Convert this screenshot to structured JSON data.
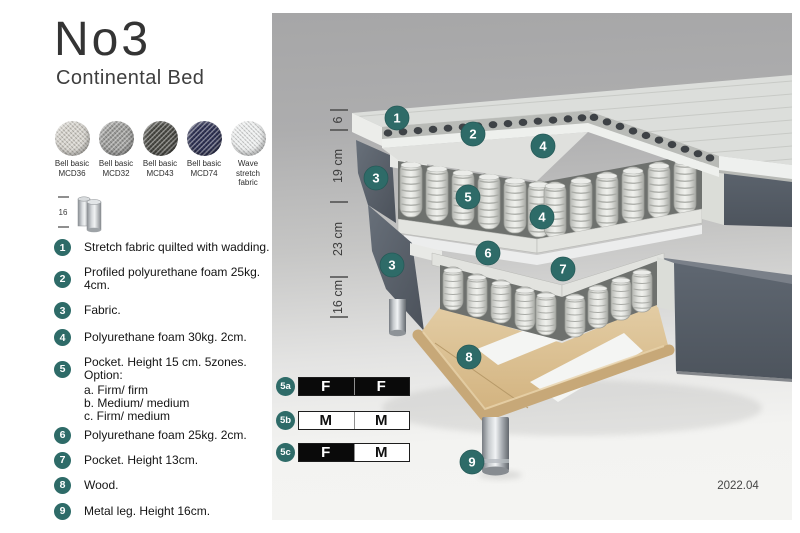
{
  "header": {
    "title": "No3",
    "subtitle": "Continental Bed"
  },
  "swatches": [
    {
      "line1": "Bell basic",
      "line2": "MCD36",
      "color": "#d5d2cb"
    },
    {
      "line1": "Bell basic",
      "line2": "MCD32",
      "color": "#9c9c9a"
    },
    {
      "line1": "Bell basic",
      "line2": "MCD43",
      "color": "#4b4b45"
    },
    {
      "line1": "Bell basic",
      "line2": "MCD74",
      "color": "#2f3254"
    },
    {
      "line1": "Wave",
      "line2": "stretch fabric",
      "color": "#edefef"
    }
  ],
  "leg_icon_label": "16",
  "legend": [
    {
      "num": "1",
      "text": "Stretch fabric quilted with wadding."
    },
    {
      "num": "2",
      "text": "Profiled polyurethane foam 25kg. 4cm."
    },
    {
      "num": "3",
      "text": "Fabric."
    },
    {
      "num": "4",
      "text": "Polyurethane foam 30kg. 2cm."
    },
    {
      "num": "5",
      "text": "Pocket. Height 15 cm. 5zones. Option:",
      "options": [
        "a. Firm/ firm",
        "b. Medium/ medium",
        "c. Firm/ medium"
      ]
    },
    {
      "num": "6",
      "text": "Polyurethane foam 25kg. 2cm."
    },
    {
      "num": "7",
      "text": "Pocket. Height 13cm."
    },
    {
      "num": "8",
      "text": "Wood."
    },
    {
      "num": "9",
      "text": "Metal leg. Height 16cm."
    }
  ],
  "dimensions": [
    "6",
    "19 cm",
    "23 cm",
    "16 cm"
  ],
  "callouts": [
    {
      "n": "1"
    },
    {
      "n": "2"
    },
    {
      "n": "4"
    },
    {
      "n": "3"
    },
    {
      "n": "5"
    },
    {
      "n": "4"
    },
    {
      "n": "6"
    },
    {
      "n": "7"
    },
    {
      "n": "3"
    },
    {
      "n": "8"
    },
    {
      "n": "9"
    }
  ],
  "firmness": {
    "rows": [
      {
        "label": "5a",
        "cells": [
          {
            "text": "F",
            "variant": "dark"
          },
          {
            "text": "F",
            "variant": "dark"
          }
        ]
      },
      {
        "label": "5b",
        "cells": [
          {
            "text": "M",
            "variant": "light"
          },
          {
            "text": "M",
            "variant": "light"
          }
        ]
      },
      {
        "label": "5c",
        "cells": [
          {
            "text": "F",
            "variant": "dark"
          },
          {
            "text": "M",
            "variant": "light"
          }
        ]
      }
    ]
  },
  "footer": {
    "version": "2022.04"
  },
  "colors": {
    "accent": "#2e6b68",
    "slate": "#596069",
    "wood": "#dcc398"
  }
}
